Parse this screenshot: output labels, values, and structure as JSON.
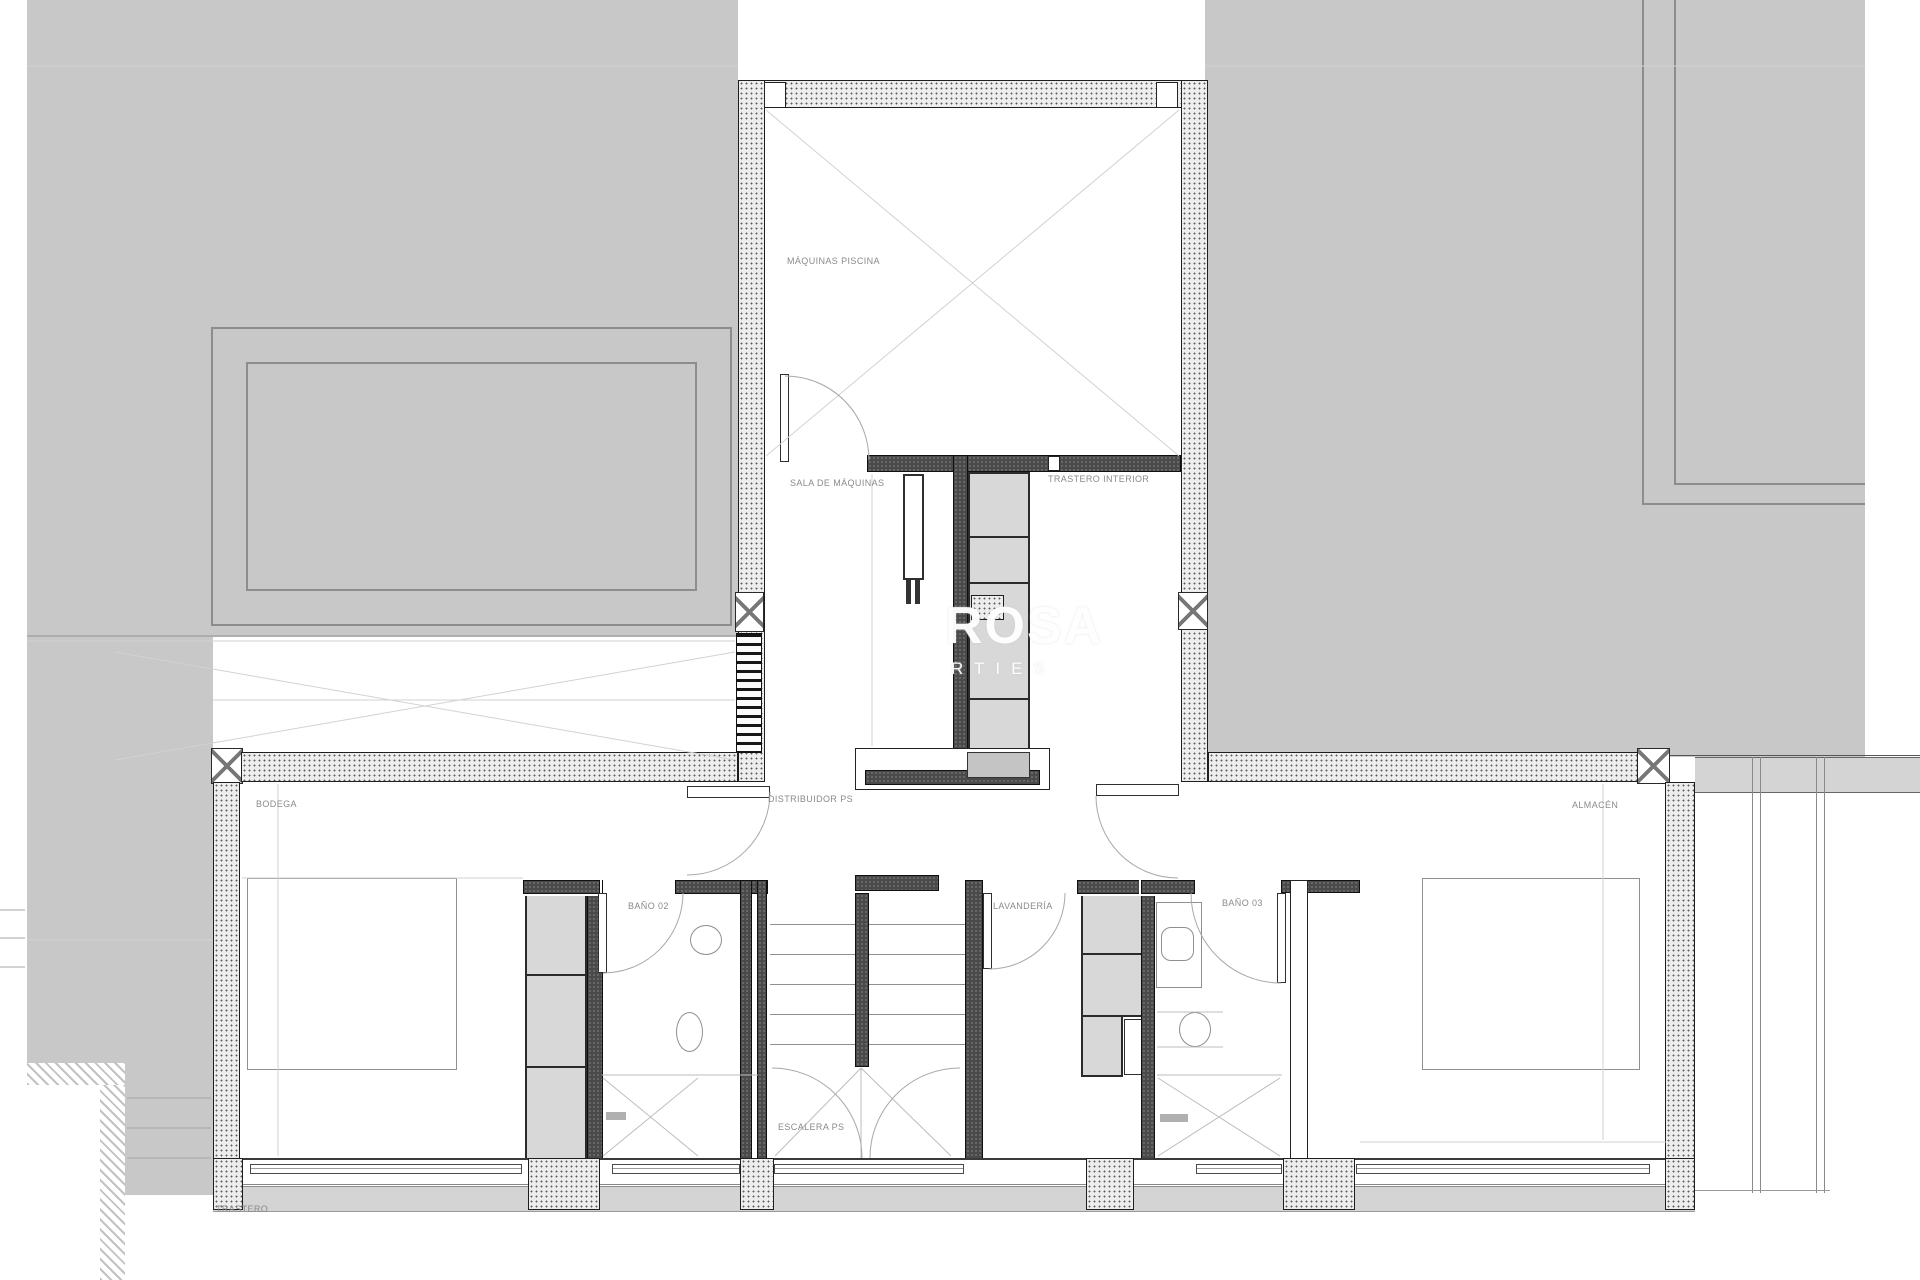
{
  "plan": {
    "watermark": {
      "line1": "ROSA",
      "line2": "RTIES"
    },
    "room_labels": {
      "maquinas_piscina": "MÁQUINAS PISCINA",
      "sala_de_maquinas": "SALA DE MÁQUINAS",
      "trastero_interior": "TRASTERO INTERIOR",
      "bodega": "BODEGA",
      "distribuidor_ps": "DISTRIBUIDOR PS",
      "bano_02": "BAÑO 02",
      "escalera_ps": "ESCALERA PS",
      "lavanderia": "LAVANDERÍA",
      "bano_03": "BAÑO 03",
      "almacen": "ALMACÉN",
      "trastero": "TRASTERO"
    },
    "colors": {
      "terrain": "#c8c8c8",
      "speckled_wall": "#ededed",
      "dark_wall": "#4a4a4a",
      "closet_cell": "#d8d8d8",
      "label_text": "#8a8a8a",
      "watermark": "#ffffff",
      "sill": "#d4d4d4"
    }
  }
}
